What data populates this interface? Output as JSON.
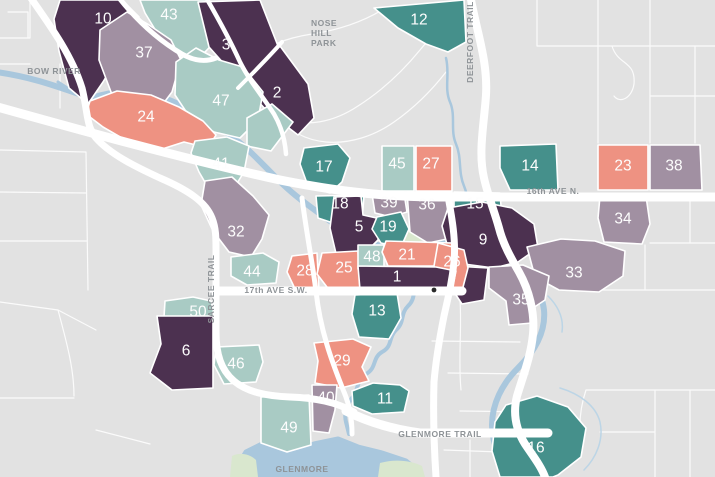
{
  "map": {
    "colors": {
      "dark": "#4c3150",
      "teal": "#45908b",
      "light_teal": "#a9cbc4",
      "mauve": "#a190a2",
      "salmon": "#ee9282",
      "background": "#e2e2e2",
      "road": "#ffffff",
      "water": "#a9c7dd",
      "park": "#d9e7ce",
      "road_label": "#8e9397",
      "district_number": "#fdfdfd"
    },
    "labels": {
      "bow_river": "BOW RIVER",
      "nose_hill_park": [
        "NOSE",
        "HILL",
        "PARK"
      ],
      "deerfoot_trail": "DEERFOOT TRAIL",
      "sixteenth_ave": "16th AVE N.",
      "sarcee_trail": "SARCEE TRAIL",
      "seventeenth_ave": "17th AVE S.W.",
      "glenmore_trail": "GLENMORE TRAIL",
      "glenmore": "GLENMORE"
    },
    "districts": [
      {
        "num": "10",
        "color": "dark",
        "x": 103,
        "y": 19,
        "points": "60,0 122,0 139,17 121,52 103,82 88,104 69,88 59,51 54,19"
      },
      {
        "num": "43",
        "color": "light_teal",
        "x": 169,
        "y": 15,
        "points": "140,0 208,0 231,25 205,52 182,58 159,36 145,13"
      },
      {
        "num": "3",
        "color": "dark",
        "x": 226,
        "y": 45,
        "points": "198,2 260,0 278,46 242,84 209,47"
      },
      {
        "num": "12",
        "color": "teal",
        "x": 419,
        "y": 20,
        "points": "374,8 464,0 466,42 448,52 426,44 398,28"
      },
      {
        "num": "2",
        "color": "dark",
        "x": 277,
        "y": 93,
        "points": "280,46 308,84 314,118 298,135 268,112 243,85"
      },
      {
        "num": "37",
        "color": "mauve",
        "x": 144,
        "y": 53,
        "points": "100,30 127,12 149,25 171,40 181,60 172,92 157,112 129,118 111,92 99,60"
      },
      {
        "num": "47",
        "color": "light_teal",
        "x": 221,
        "y": 101,
        "points": "176,62 196,48 219,60 243,67 263,92 258,120 240,138 214,132 191,119 175,95",
        "points2": "247,118 272,104 293,122 271,151 247,146"
      },
      {
        "num": "24",
        "color": "salmon",
        "x": 146,
        "y": 117,
        "points": "90,101 117,91 151,95 179,107 203,121 216,135 208,148 184,142 159,150 129,142 103,127 86,114"
      },
      {
        "num": "41",
        "color": "light_teal",
        "x": 221,
        "y": 164,
        "points": "195,141 227,137 249,146 244,172 231,193 213,196 199,172 191,153"
      },
      {
        "num": "17",
        "color": "teal",
        "x": 324,
        "y": 167,
        "points": "304,148 338,144 350,158 342,182 330,193 308,186 300,164"
      },
      {
        "num": "45",
        "color": "light_teal",
        "x": 397,
        "y": 164,
        "points": "382,146 414,146 414,191 382,191"
      },
      {
        "num": "27",
        "color": "salmon",
        "x": 431,
        "y": 164,
        "points": "416,146 452,146 452,191 416,191"
      },
      {
        "num": "14",
        "color": "teal",
        "x": 530,
        "y": 166,
        "points": "500,146 556,144 558,190 510,190 500,168"
      },
      {
        "num": "23",
        "color": "salmon",
        "x": 623,
        "y": 166,
        "points": "598,145 648,145 648,190 598,190"
      },
      {
        "num": "38",
        "color": "mauve",
        "x": 674,
        "y": 166,
        "points": "650,145 700,145 702,190 650,190"
      },
      {
        "num": "34",
        "color": "mauve",
        "x": 623,
        "y": 219,
        "points": "600,196 646,196 650,224 642,244 604,242 598,218"
      },
      {
        "num": "18",
        "color": "teal",
        "x": 340,
        "y": 204,
        "points": "316,196 364,195 362,222 336,224 318,218"
      },
      {
        "num": "39",
        "color": "mauve",
        "x": 389,
        "y": 203,
        "points": "372,194 404,193 407,212 391,217 375,213"
      },
      {
        "num": "36",
        "color": "mauve",
        "x": 427,
        "y": 205,
        "points": "407,192 452,192 452,238 428,243 410,232"
      },
      {
        "num": "15",
        "color": "teal",
        "x": 475,
        "y": 204,
        "points": "454,192 500,193 502,219 470,223 454,216"
      },
      {
        "num": "5",
        "color": "dark",
        "x": 359,
        "y": 227,
        "points": "334,197 361,196 363,215 381,219 378,240 366,252 369,262 338,262 330,228"
      },
      {
        "num": "19",
        "color": "teal",
        "x": 388,
        "y": 227,
        "points": "377,217 401,212 409,229 401,247 381,243 372,229"
      },
      {
        "num": "9",
        "color": "dark",
        "x": 483,
        "y": 240,
        "points": "448,208 482,202 512,208 534,224 538,248 518,262 494,268 464,264 448,248 442,226",
        "points2": "454,266 488,268 484,300 462,304 450,286"
      },
      {
        "num": "32",
        "color": "mauve",
        "x": 236,
        "y": 232,
        "points": "205,181 232,177 253,196 269,215 262,239 251,257 229,252 213,231 201,205"
      },
      {
        "num": "44",
        "color": "light_teal",
        "x": 252,
        "y": 272,
        "points": "231,257 263,253 279,262 276,283 247,285 231,276"
      },
      {
        "num": "28",
        "color": "salmon",
        "x": 305,
        "y": 271,
        "points": "292,256 317,253 319,290 296,291 287,272"
      },
      {
        "num": "25",
        "color": "salmon",
        "x": 344,
        "y": 268,
        "points": "322,253 358,251 360,290 330,291 317,274"
      },
      {
        "num": "48",
        "color": "light_teal",
        "x": 372,
        "y": 257,
        "points": "358,245 384,245 384,269 358,269"
      },
      {
        "num": "21",
        "color": "salmon",
        "x": 407,
        "y": 255,
        "points": "386,241 452,243 450,266 388,266 382,252"
      },
      {
        "num": "26",
        "color": "salmon",
        "x": 452,
        "y": 262,
        "points": "438,243 464,250 468,268 462,291 442,291 434,266"
      },
      {
        "num": "1",
        "color": "dark",
        "x": 397,
        "y": 277,
        "points": "358,266 436,267 456,271 452,290 360,290"
      },
      {
        "num": "33",
        "color": "mauve",
        "x": 574,
        "y": 273,
        "points": "527,247 561,239 595,241 625,251 623,276 599,292 559,290 535,277"
      },
      {
        "num": "35",
        "color": "mauve",
        "x": 521,
        "y": 300,
        "points": "489,267 523,265 549,276 545,300 533,308 532,323 509,325 506,301 489,288"
      },
      {
        "num": "13",
        "color": "teal",
        "x": 377,
        "y": 311,
        "points": "355,295 397,293 401,318 389,339 359,337 352,314"
      },
      {
        "num": "50",
        "color": "light_teal",
        "x": 198,
        "y": 312,
        "points": "165,301 193,297 211,301 215,316 202,328 177,330 164,317"
      },
      {
        "num": "6",
        "color": "dark",
        "x": 186,
        "y": 351,
        "points": "157,316 213,316 213,388 172,390 150,373 161,344"
      },
      {
        "num": "46",
        "color": "light_teal",
        "x": 236,
        "y": 364,
        "points": "216,347 259,345 263,362 256,382 224,384 214,365"
      },
      {
        "num": "29",
        "color": "salmon",
        "x": 342,
        "y": 361,
        "points": "314,343 353,339 371,347 362,367 369,381 341,388 315,383 318,361"
      },
      {
        "num": "40",
        "color": "mauve",
        "x": 326,
        "y": 398,
        "points": "312,385 337,385 335,410 329,433 313,431"
      },
      {
        "num": "11",
        "color": "teal",
        "x": 385,
        "y": 399,
        "points": "352,391 373,383 400,385 409,391 404,412 372,414 353,406"
      },
      {
        "num": "49",
        "color": "light_teal",
        "x": 289,
        "y": 428,
        "points": "261,397 309,395 311,445 287,452 261,443"
      },
      {
        "num": "16",
        "color": "teal",
        "x": 536,
        "y": 448,
        "points": "506,405 537,396 568,407 586,428 581,457 558,475 553,477 500,477 492,451 495,422"
      }
    ]
  }
}
